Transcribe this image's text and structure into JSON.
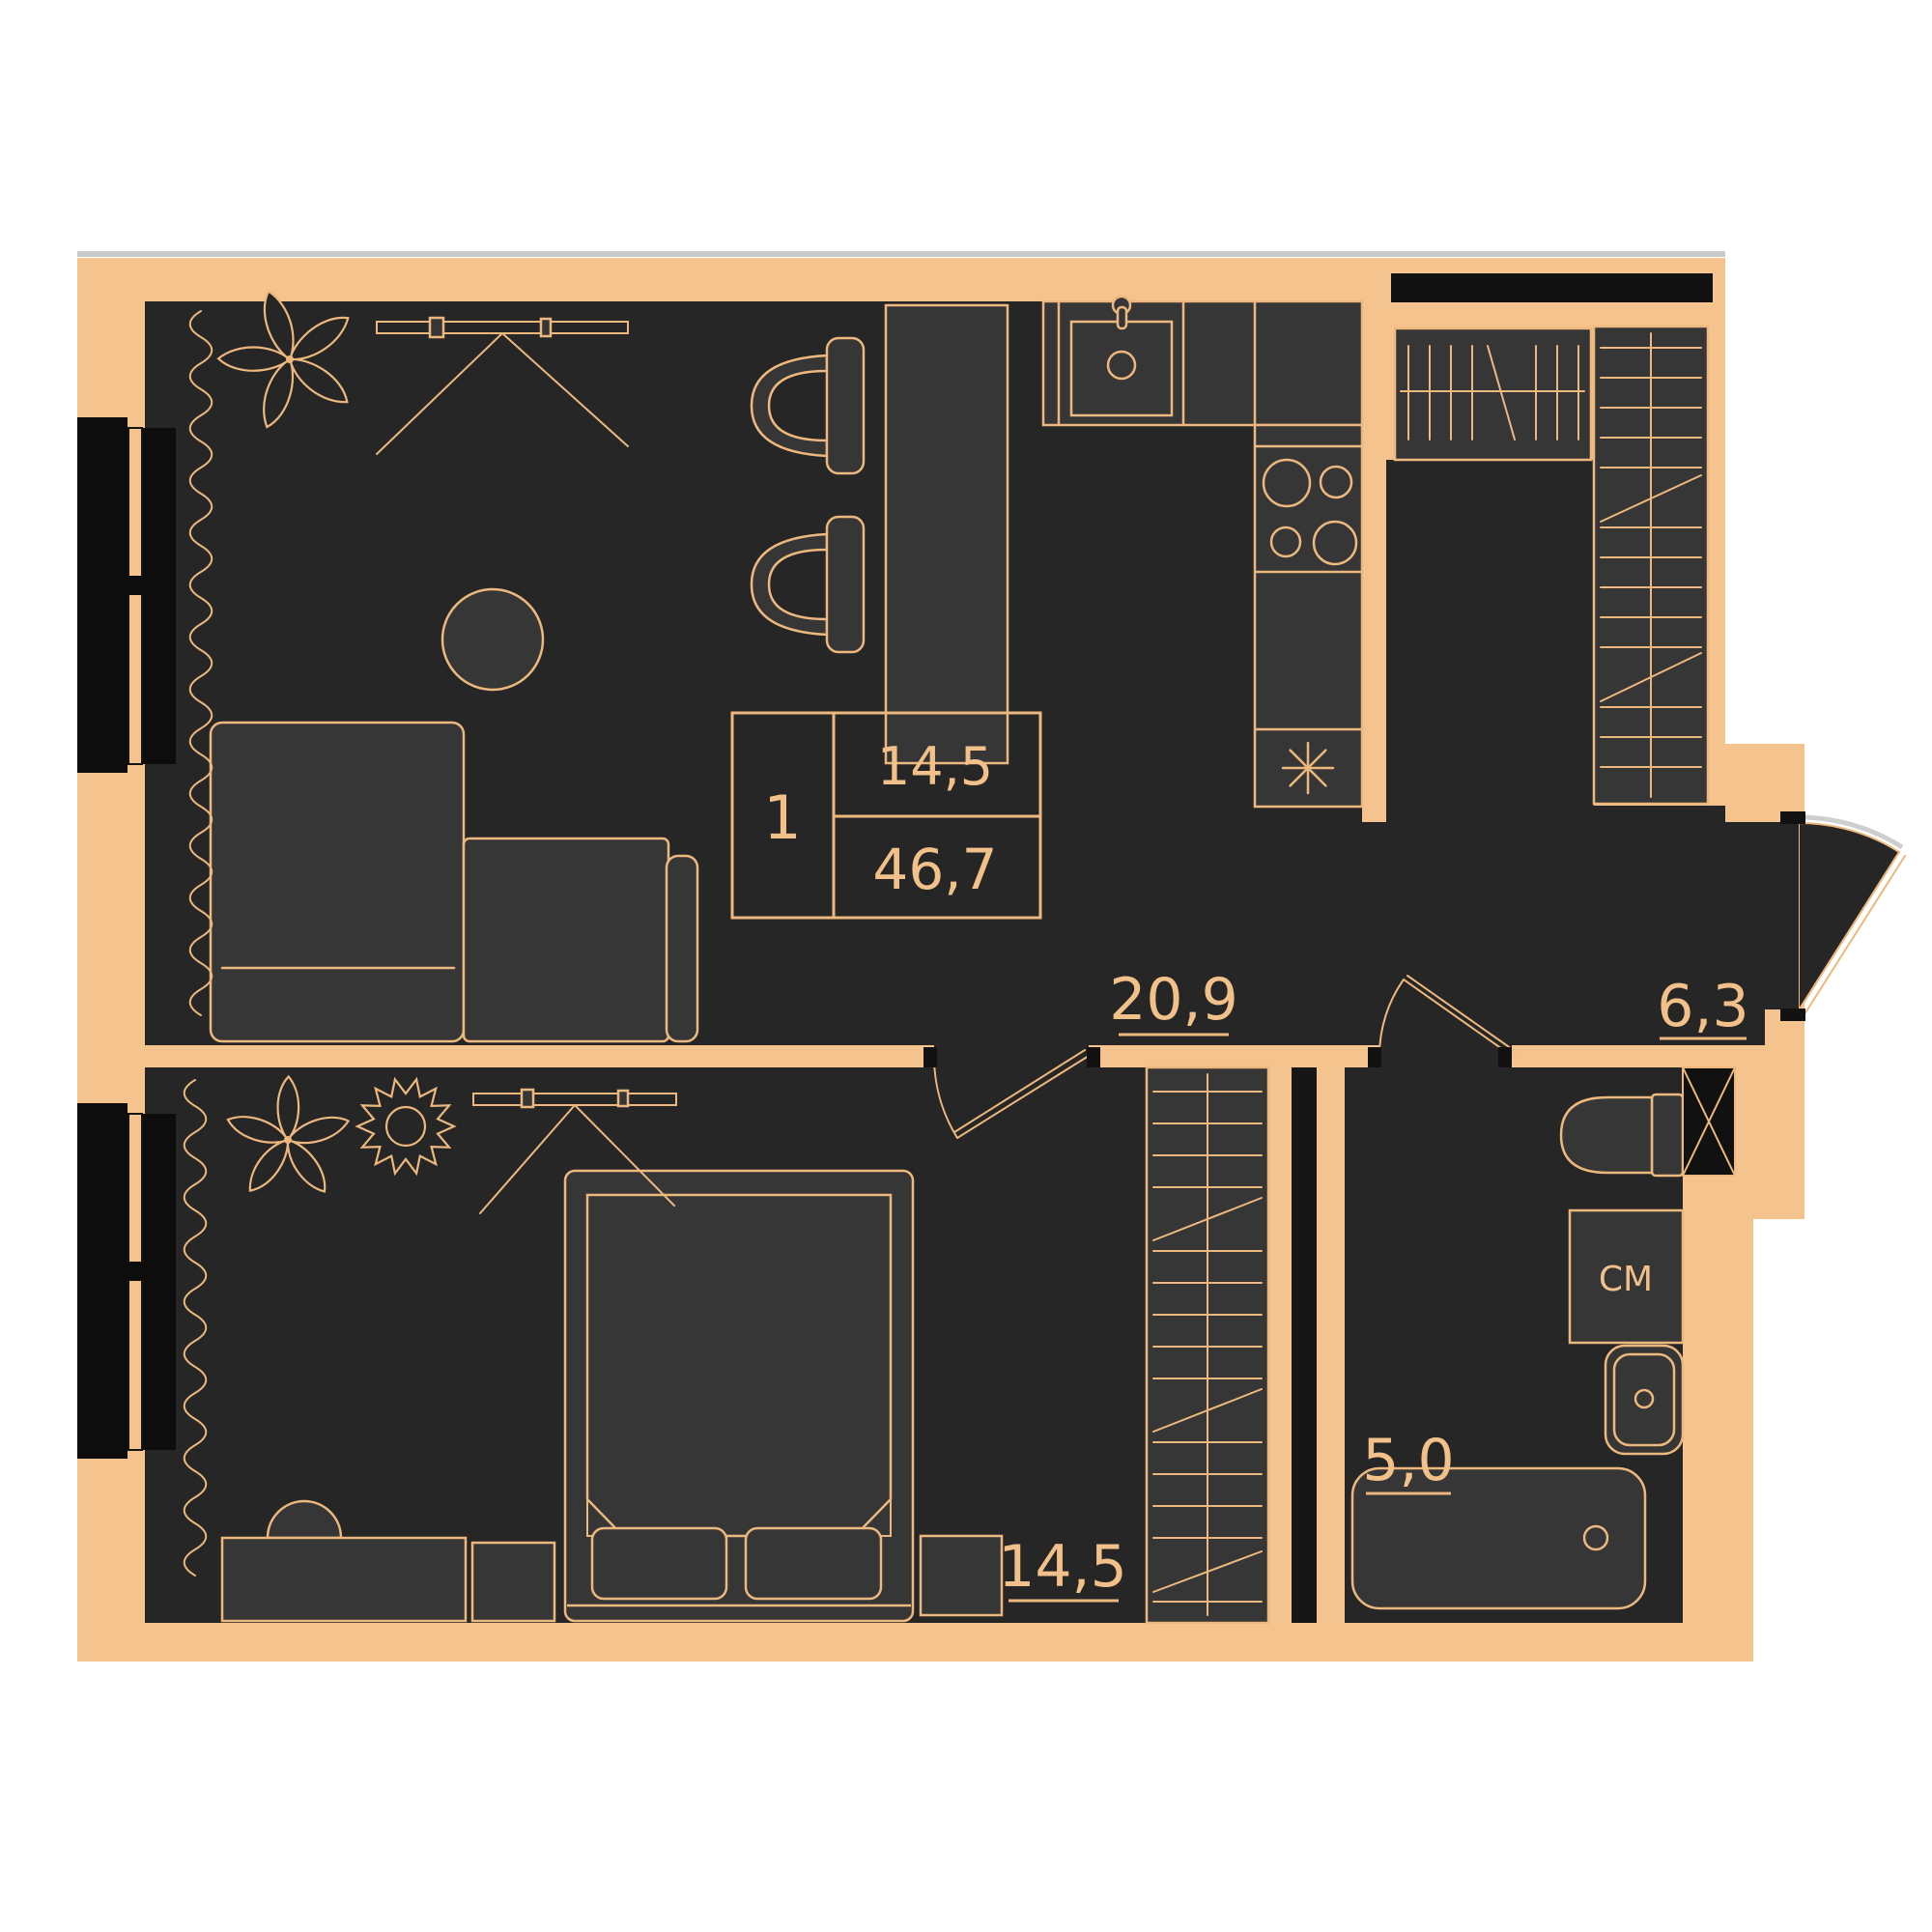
{
  "plan": {
    "info_box": {
      "rooms_count": "1",
      "room_area": "14,5",
      "total_area": "46,7"
    },
    "rooms": [
      {
        "id": "living-kitchen",
        "area_label": "20,9"
      },
      {
        "id": "hallway",
        "area_label": "6,3"
      },
      {
        "id": "bedroom",
        "area_label": "14,5"
      },
      {
        "id": "bathroom",
        "area_label": "5,0"
      }
    ],
    "appliances": {
      "washing_machine_label": "СМ"
    },
    "colors": {
      "wall": "#F5C48E",
      "line": "#EDB87D",
      "text": "#F2C189",
      "room": "#262626",
      "furn": "#363636",
      "black": "#121212"
    }
  }
}
